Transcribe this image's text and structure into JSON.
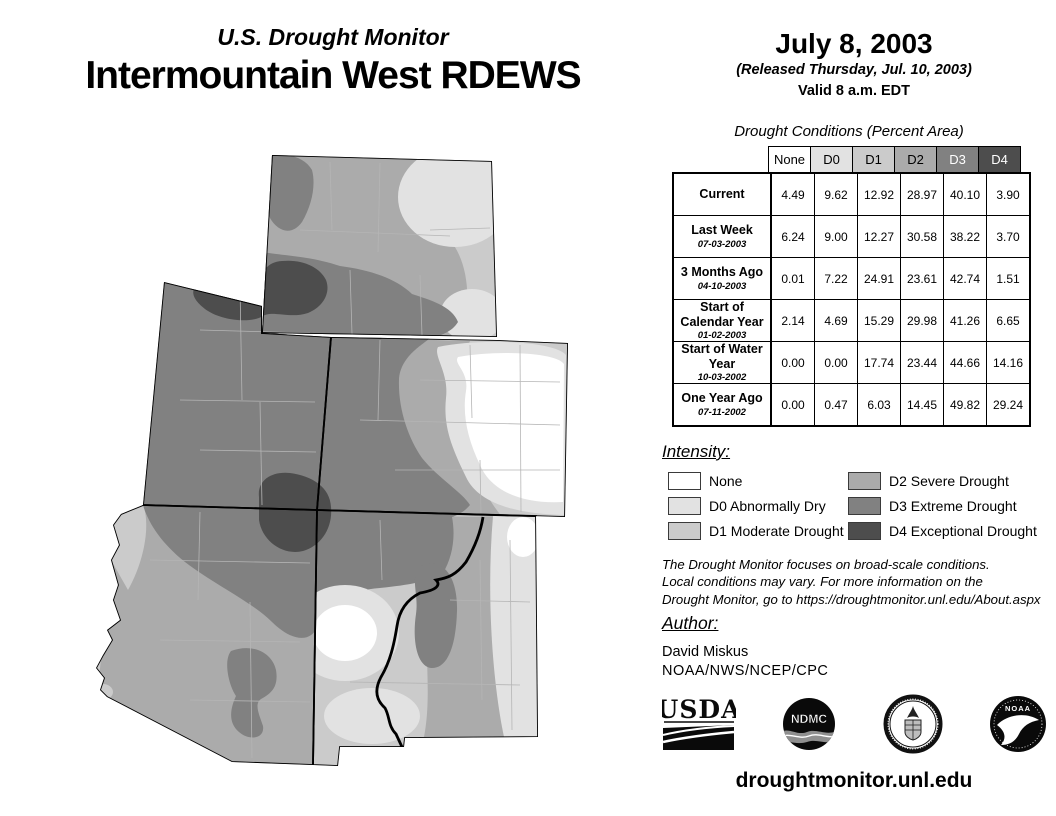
{
  "header": {
    "supertitle": "U.S. Drought Monitor",
    "title": "Intermountain West RDEWS"
  },
  "date_block": {
    "date": "July 8, 2003",
    "released": "(Released Thursday, Jul. 10, 2003)",
    "valid": "Valid 8 a.m. EDT"
  },
  "table": {
    "caption": "Drought Conditions (Percent Area)",
    "columns": [
      "None",
      "D0",
      "D1",
      "D2",
      "D3",
      "D4"
    ],
    "column_color_keys": [
      "none",
      "d0",
      "d1",
      "d2",
      "d3",
      "d4"
    ],
    "rows": [
      {
        "label": "Current",
        "date": "",
        "values": [
          "4.49",
          "9.62",
          "12.92",
          "28.97",
          "40.10",
          "3.90"
        ]
      },
      {
        "label": "Last Week",
        "date": "07-03-2003",
        "values": [
          "6.24",
          "9.00",
          "12.27",
          "30.58",
          "38.22",
          "3.70"
        ]
      },
      {
        "label": "3 Months Ago",
        "date": "04-10-2003",
        "values": [
          "0.01",
          "7.22",
          "24.91",
          "23.61",
          "42.74",
          "1.51"
        ]
      },
      {
        "label": "Start of Calendar Year",
        "date": "01-02-2003",
        "values": [
          "2.14",
          "4.69",
          "15.29",
          "29.98",
          "41.26",
          "6.65"
        ]
      },
      {
        "label": "Start of Water Year",
        "date": "10-03-2002",
        "values": [
          "0.00",
          "0.00",
          "17.74",
          "23.44",
          "44.66",
          "14.16"
        ]
      },
      {
        "label": "One Year Ago",
        "date": "07-11-2002",
        "values": [
          "0.00",
          "0.47",
          "6.03",
          "14.45",
          "49.82",
          "29.24"
        ]
      }
    ]
  },
  "legend": {
    "heading": "Intensity:",
    "items": [
      {
        "label": "None",
        "color_key": "none"
      },
      {
        "label": "D0 Abnormally Dry",
        "color_key": "d0"
      },
      {
        "label": "D1 Moderate Drought",
        "color_key": "d1"
      },
      {
        "label": "D2 Severe Drought",
        "color_key": "d2"
      },
      {
        "label": "D3 Extreme Drought",
        "color_key": "d3"
      },
      {
        "label": "D4 Exceptional Drought",
        "color_key": "d4"
      }
    ]
  },
  "colors": {
    "none": "#ffffff",
    "d0": "#e2e2e2",
    "d1": "#cbcbcb",
    "d2": "#ababab",
    "d3": "#818181",
    "d4": "#4d4d4d"
  },
  "disclaimer": {
    "lines": [
      "The Drought Monitor focuses on broad-scale conditions.",
      "Local conditions may vary. For more information on the",
      "Drought Monitor, go to https://droughtmonitor.unl.edu/About.aspx"
    ]
  },
  "author": {
    "heading": "Author:",
    "name": "David Miskus",
    "org": "NOAA/NWS/NCEP/CPC"
  },
  "logos": [
    {
      "name": "usda-logo",
      "label": "USDA"
    },
    {
      "name": "ndmc-logo",
      "label": "NDMC"
    },
    {
      "name": "commerce-seal",
      "label": ""
    },
    {
      "name": "noaa-logo",
      "label": "NOAA"
    }
  ],
  "footer": {
    "url": "droughtmonitor.unl.edu"
  }
}
